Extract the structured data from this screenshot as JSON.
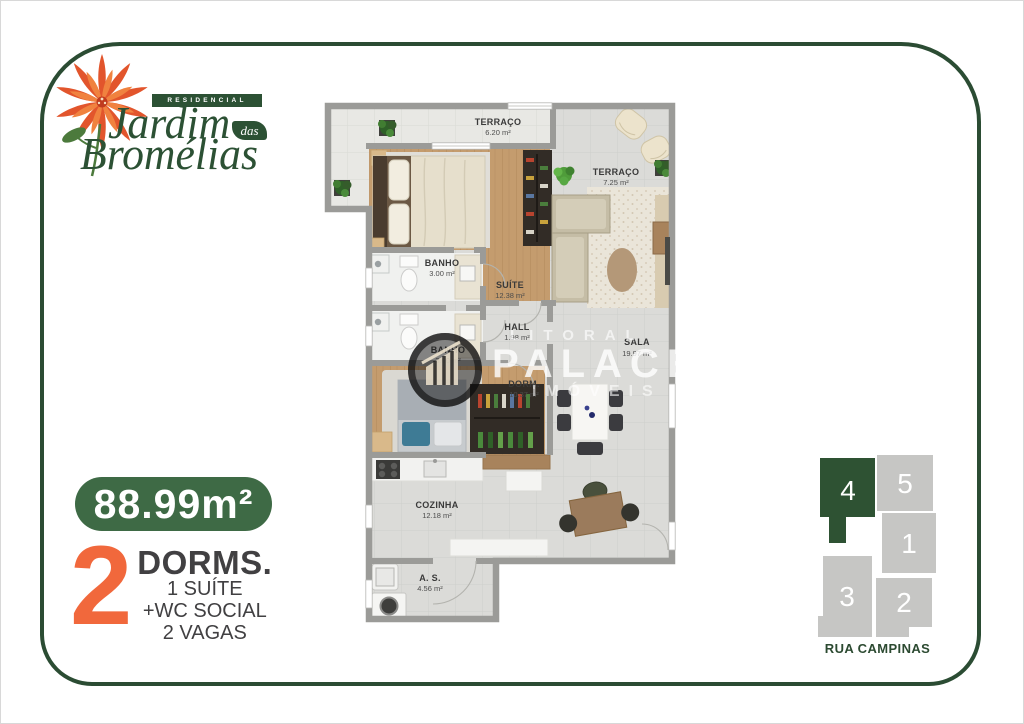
{
  "brand": {
    "residencial": "RESIDENCIAL",
    "name_line1": "Jardim",
    "name_connector": "das",
    "name_line2": "Bromélias"
  },
  "plan": {
    "rooms": [
      {
        "id": "terraco-top",
        "name": "TERRAÇO",
        "area": "6.20 m²"
      },
      {
        "id": "terraco-right",
        "name": "TERRAÇO",
        "area": "7.25 m²"
      },
      {
        "id": "banho-suite",
        "name": "BANHO",
        "area": "3.00 m²"
      },
      {
        "id": "suite",
        "name": "SUÍTE",
        "area": "12.38 m²"
      },
      {
        "id": "hall",
        "name": "HALL",
        "area": "1.98 m²"
      },
      {
        "id": "banho-social",
        "name": "BANHO",
        "area": "3.00 m²"
      },
      {
        "id": "dormitorio",
        "name": "DORM.",
        "area": "10.37 m²"
      },
      {
        "id": "sala",
        "name": "SALA",
        "area": "19.97 m²"
      },
      {
        "id": "cozinha",
        "name": "COZINHA",
        "area": "12.18 m²"
      },
      {
        "id": "area-servico",
        "name": "A. S.",
        "area": "4.56 m²"
      }
    ]
  },
  "watermark": {
    "top": "LITORAL",
    "middle": "PALACE",
    "bottom": "IMÓVEIS"
  },
  "summary": {
    "total_area": "88.99m²",
    "dorms_count": "2",
    "dorms_label": "DORMS.",
    "details": [
      "1 SUÍTE",
      "+WC SOCIAL",
      "2 VAGAS"
    ]
  },
  "keyplan": {
    "units": [
      {
        "number": "4",
        "highlighted": true
      },
      {
        "number": "5",
        "highlighted": false
      },
      {
        "number": "1",
        "highlighted": false
      },
      {
        "number": "3",
        "highlighted": false
      },
      {
        "number": "2",
        "highlighted": false
      }
    ],
    "street": "RUA CAMPINAS"
  },
  "colors": {
    "frame_green": "#2b4c33",
    "logo_green": "#2c5134",
    "badge_green": "#3e6a45",
    "accent_orange": "#f1683c",
    "keyplan_highlight": "#2e5233",
    "keyplan_gray": "#c6c6c4"
  }
}
